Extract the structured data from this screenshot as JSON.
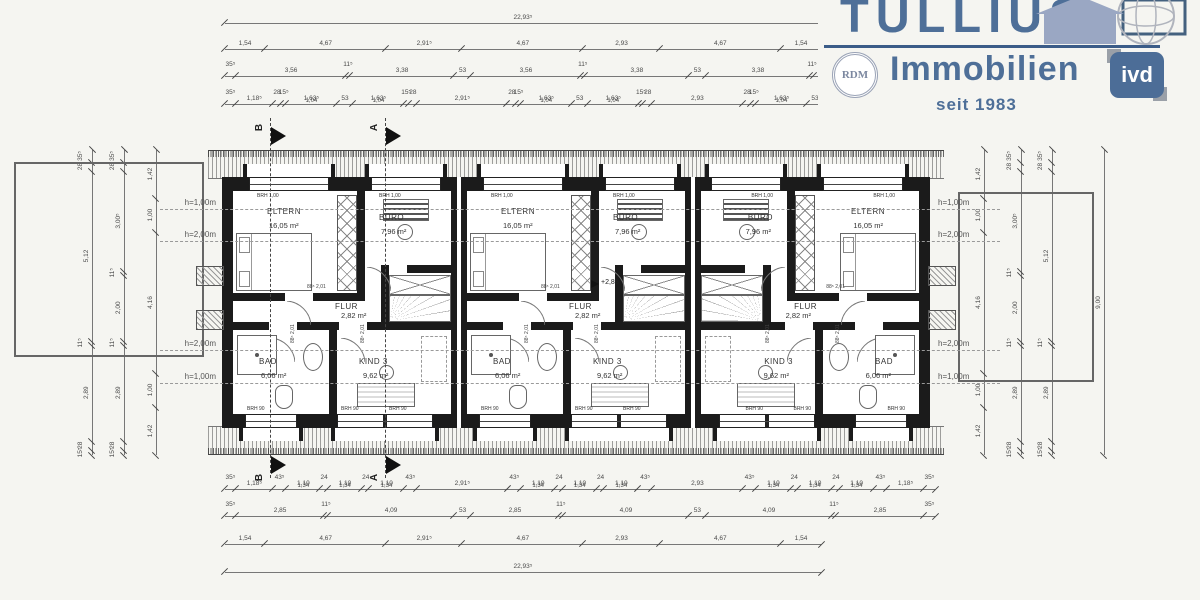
{
  "logo": {
    "title": "TULLIUS",
    "subtitle": "Immobilien",
    "since": "seit 1983",
    "rdm": "RDM",
    "ivd": "ivd"
  },
  "colors": {
    "brand": "#4e6f98",
    "accent_line": "#3b5c88",
    "house_fill": "#9aa7c3"
  },
  "plan": {
    "door": {
      "w": "88⁵",
      "h": "2,01"
    },
    "level_label": "+2,88",
    "sills": {
      "top": "BRH 1,00",
      "bottom": "BRH 90"
    },
    "sections": {
      "a": "A",
      "b": "B"
    },
    "heights": {
      "h100": "h=1,00m",
      "h200": "h=2,00m"
    },
    "units": [
      {
        "rooms": {
          "eltern": {
            "label": "ELTERN",
            "area": "16,05 m²"
          },
          "buero": {
            "label": "BÜRO",
            "area": "7,96 m²"
          },
          "flur": {
            "label": "FLUR",
            "area": "2,82 m²"
          },
          "bad": {
            "label": "BAD",
            "area": "6,06 m²"
          },
          "kind": {
            "label": "KIND 3",
            "area": "9,62 m²"
          }
        }
      },
      {
        "rooms": {
          "eltern": {
            "label": "ELTERN",
            "area": "16,05 m²"
          },
          "buero": {
            "label": "BÜRO",
            "area": "7,96 m²"
          },
          "flur": {
            "label": "FLUR",
            "area": "2,82 m²"
          },
          "bad": {
            "label": "BAD",
            "area": "6,06 m²"
          },
          "kind": {
            "label": "KIND 3",
            "area": "9,62 m²"
          }
        }
      },
      {
        "rooms": {
          "eltern": {
            "label": "ELTERN",
            "area": "16,05 m²"
          },
          "buero": {
            "label": "BÜRO",
            "area": "7,96 m²"
          },
          "flur": {
            "label": "FLUR",
            "area": "2,82 m²"
          },
          "bad": {
            "label": "BAD",
            "area": "6,06 m²"
          },
          "kind": {
            "label": "KIND 3",
            "area": "9,62 m²"
          }
        }
      }
    ]
  },
  "dims": {
    "top1": [
      {
        "l": "22,93⁵",
        "m": 22.935
      }
    ],
    "top2": [
      {
        "l": "1,54",
        "m": 1.54
      },
      {
        "l": "4,67",
        "m": 4.67
      },
      {
        "l": "2,91⁵",
        "m": 2.915
      },
      {
        "l": "4,67",
        "m": 4.67
      },
      {
        "l": "2,93",
        "m": 2.93
      },
      {
        "l": "4,67",
        "m": 4.67
      },
      {
        "l": "1,54",
        "m": 1.54
      }
    ],
    "top3": [
      {
        "l": "35⁵",
        "m": 0.355
      },
      {
        "l": "3,56",
        "m": 3.56
      },
      {
        "l": "11⁵",
        "m": 0.115
      },
      {
        "l": "3,38",
        "m": 3.38
      },
      {
        "l": "53",
        "m": 0.53
      },
      {
        "l": "3,56",
        "m": 3.56
      },
      {
        "l": "11⁵",
        "m": 0.115
      },
      {
        "l": "3,38",
        "m": 3.38
      },
      {
        "l": "53",
        "m": 0.53
      },
      {
        "l": "3,38",
        "m": 3.38
      },
      {
        "l": "11⁵",
        "m": 0.115
      },
      {
        "l": "3,56",
        "m": 3.56
      },
      {
        "l": "35⁵",
        "m": 0.355
      }
    ],
    "top4": [
      {
        "l": "35⁵",
        "m": 0.355
      },
      {
        "l": "1,18⁵",
        "m": 1.185
      },
      {
        "l": "28",
        "m": 0.28
      },
      {
        "l": "15⁵",
        "m": 0.155
      },
      {
        "l": "1,63⁵",
        "s": "1,04",
        "m": 1.635
      },
      {
        "l": "53",
        "m": 0.53
      },
      {
        "l": "1,63⁵",
        "s": "1,04",
        "m": 1.635
      },
      {
        "l": "15⁵",
        "m": 0.155
      },
      {
        "l": "28",
        "m": 0.28
      },
      {
        "l": "2,91⁵",
        "m": 2.915
      },
      {
        "l": "28",
        "m": 0.28
      },
      {
        "l": "15⁵",
        "m": 0.155
      },
      {
        "l": "1,63⁵",
        "s": "1,04",
        "m": 1.635
      },
      {
        "l": "53",
        "m": 0.53
      },
      {
        "l": "1,63⁵",
        "s": "1,04",
        "m": 1.635
      },
      {
        "l": "15⁵",
        "m": 0.155
      },
      {
        "l": "28",
        "m": 0.28
      },
      {
        "l": "2,93",
        "m": 2.93
      },
      {
        "l": "28",
        "m": 0.28
      },
      {
        "l": "15⁵",
        "m": 0.155
      },
      {
        "l": "1,63⁵",
        "s": "1,04",
        "m": 1.635
      },
      {
        "l": "53",
        "m": 0.53
      },
      {
        "l": "1,63⁵",
        "s": "1,04",
        "m": 1.635
      },
      {
        "l": "15⁵",
        "m": 0.155
      },
      {
        "l": "28",
        "m": 0.28
      },
      {
        "l": "1,18⁵",
        "m": 1.185
      },
      {
        "l": "35⁵",
        "m": 0.355
      }
    ],
    "bot1": [
      {
        "l": "35⁵",
        "m": 0.355
      },
      {
        "l": "1,18⁵",
        "m": 1.185
      },
      {
        "l": "43⁵",
        "m": 0.435
      },
      {
        "l": "1,10",
        "s": "1,34",
        "m": 1.1
      },
      {
        "l": "24",
        "m": 0.24
      },
      {
        "l": "1,10",
        "s": "1,34",
        "m": 1.1
      },
      {
        "l": "24",
        "m": 0.24
      },
      {
        "l": "1,10",
        "s": "1,34",
        "m": 1.1
      },
      {
        "l": "43⁵",
        "m": 0.435
      },
      {
        "l": "2,91⁵",
        "m": 2.915
      },
      {
        "l": "43⁵",
        "m": 0.435
      },
      {
        "l": "1,10",
        "s": "1,34",
        "m": 1.1
      },
      {
        "l": "24",
        "m": 0.24
      },
      {
        "l": "1,10",
        "s": "1,34",
        "m": 1.1
      },
      {
        "l": "24",
        "m": 0.24
      },
      {
        "l": "1,10",
        "s": "1,34",
        "m": 1.1
      },
      {
        "l": "43⁵",
        "m": 0.435
      },
      {
        "l": "2,93",
        "m": 2.93
      },
      {
        "l": "43⁵",
        "m": 0.435
      },
      {
        "l": "1,10",
        "s": "1,34",
        "m": 1.1
      },
      {
        "l": "24",
        "m": 0.24
      },
      {
        "l": "1,10",
        "s": "1,34",
        "m": 1.1
      },
      {
        "l": "24",
        "m": 0.24
      },
      {
        "l": "1,10",
        "s": "1,34",
        "m": 1.1
      },
      {
        "l": "43⁵",
        "m": 0.435
      },
      {
        "l": "1,18⁵",
        "m": 1.185
      },
      {
        "l": "35⁵",
        "m": 0.355
      }
    ],
    "bot2": [
      {
        "l": "35⁵",
        "m": 0.355
      },
      {
        "l": "2,85",
        "m": 2.85
      },
      {
        "l": "11⁵",
        "m": 0.115
      },
      {
        "l": "4,09",
        "m": 4.09
      },
      {
        "l": "53",
        "m": 0.53
      },
      {
        "l": "2,85",
        "m": 2.85
      },
      {
        "l": "11⁵",
        "m": 0.115
      },
      {
        "l": "4,09",
        "m": 4.09
      },
      {
        "l": "53",
        "m": 0.53
      },
      {
        "l": "4,09",
        "m": 4.09
      },
      {
        "l": "11⁵",
        "m": 0.115
      },
      {
        "l": "2,85",
        "m": 2.85
      },
      {
        "l": "35⁵",
        "m": 0.355
      }
    ],
    "bot3": [
      {
        "l": "1,54",
        "m": 1.54
      },
      {
        "l": "4,67",
        "m": 4.67
      },
      {
        "l": "2,91⁵",
        "m": 2.915
      },
      {
        "l": "4,67",
        "m": 4.67
      },
      {
        "l": "2,93",
        "m": 2.93
      },
      {
        "l": "4,67",
        "m": 4.67
      },
      {
        "l": "1,54",
        "m": 1.54
      }
    ],
    "bot4": [
      {
        "l": "22,93⁵",
        "m": 22.935
      }
    ],
    "left_outer": [
      {
        "l": "35⁵",
        "m": 0.355
      },
      {
        "l": "28",
        "m": 0.28
      },
      {
        "l": "5,12",
        "m": 5.12
      },
      {
        "l": "11⁵",
        "m": 0.115
      },
      {
        "l": "2,89",
        "m": 2.89
      },
      {
        "l": "28",
        "m": 0.28
      },
      {
        "l": "15⁵",
        "m": 0.155
      }
    ],
    "left_mid": [
      {
        "l": "35⁵",
        "m": 0.355
      },
      {
        "l": "28",
        "m": 0.28
      },
      {
        "l": "3,00⁵",
        "m": 3.005
      },
      {
        "l": "11⁵",
        "m": 0.115
      },
      {
        "l": "2,00",
        "m": 2.0
      },
      {
        "l": "11⁵",
        "m": 0.115
      },
      {
        "l": "2,89",
        "m": 2.89
      },
      {
        "l": "28",
        "m": 0.28
      },
      {
        "l": "15⁵",
        "m": 0.155
      }
    ],
    "left_in": [
      {
        "l": "1,42",
        "m": 1.42
      },
      {
        "l": "1,00",
        "m": 1.0
      },
      {
        "l": "4,16",
        "m": 4.16
      },
      {
        "l": "1,00",
        "m": 1.0
      },
      {
        "l": "1,42",
        "m": 1.42
      }
    ],
    "right_in": [
      {
        "l": "1,42",
        "m": 1.42
      },
      {
        "l": "1,00",
        "m": 1.0
      },
      {
        "l": "4,16",
        "m": 4.16
      },
      {
        "l": "1,00",
        "m": 1.0
      },
      {
        "l": "1,42",
        "m": 1.42
      }
    ],
    "right_mid": [
      {
        "l": "35⁵",
        "m": 0.355
      },
      {
        "l": "28",
        "m": 0.28
      },
      {
        "l": "3,00⁵",
        "m": 3.005
      },
      {
        "l": "11⁵",
        "m": 0.115
      },
      {
        "l": "2,00",
        "m": 2.0
      },
      {
        "l": "11⁵",
        "m": 0.115
      },
      {
        "l": "2,89",
        "m": 2.89
      },
      {
        "l": "28",
        "m": 0.28
      },
      {
        "l": "15⁵",
        "m": 0.155
      }
    ],
    "right_outer": [
      {
        "l": "35⁵",
        "m": 0.355
      },
      {
        "l": "28",
        "m": 0.28
      },
      {
        "l": "5,12",
        "m": 5.12
      },
      {
        "l": "11⁵",
        "m": 0.115
      },
      {
        "l": "2,89",
        "m": 2.89
      },
      {
        "l": "28",
        "m": 0.28
      },
      {
        "l": "15⁵",
        "m": 0.155
      }
    ],
    "right_total": [
      {
        "l": "9,00",
        "m": 9.0
      }
    ]
  }
}
